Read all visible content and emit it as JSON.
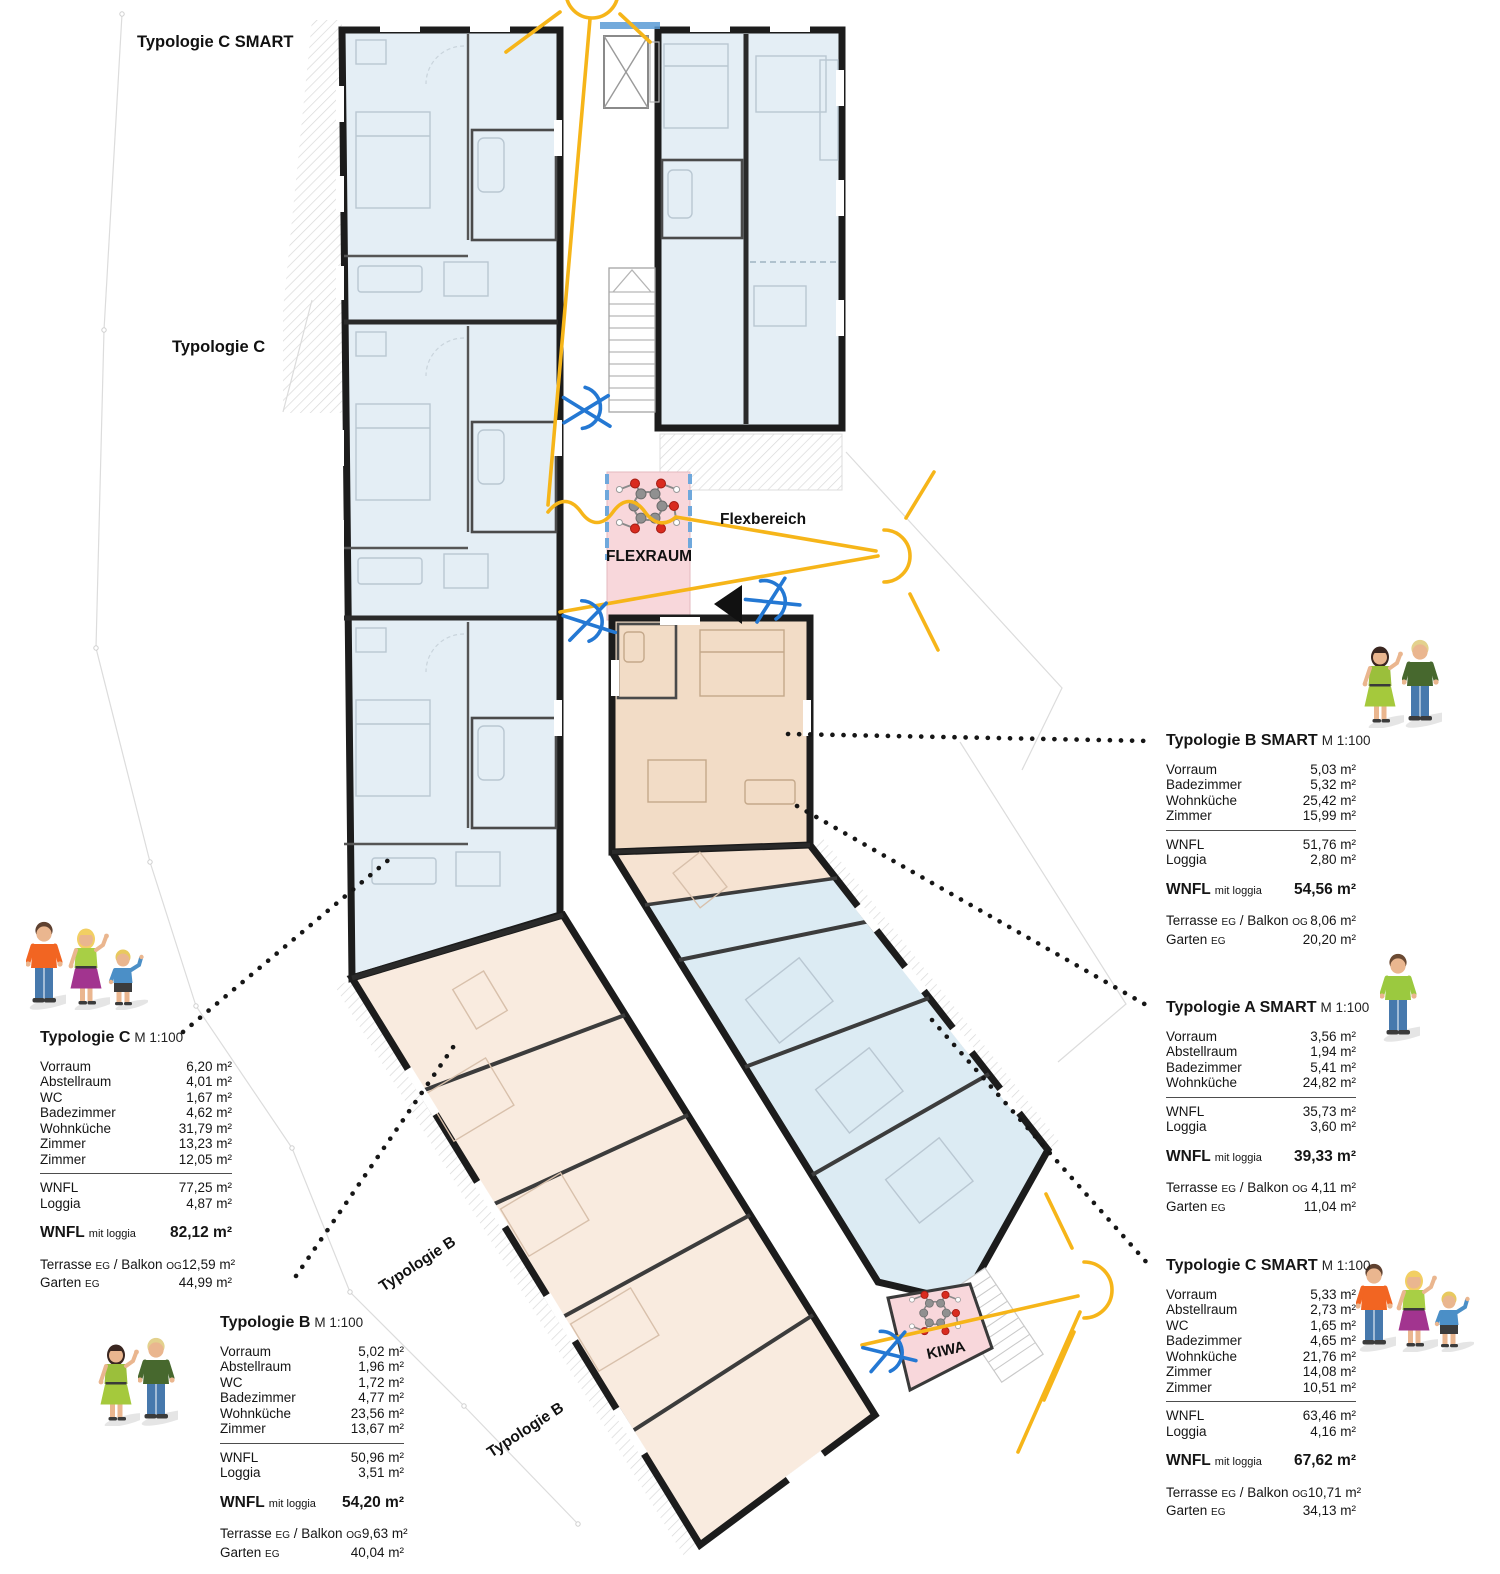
{
  "plan": {
    "labels": {
      "typologie_c_smart": "Typologie C SMART",
      "typologie_c": "Typologie C",
      "typologie_b": "Typologie B",
      "flexraum": "FLEXRAUM",
      "flexbereich": "Flexbereich",
      "kiwa": "KIWA"
    },
    "colors": {
      "room_blue": "#e4eef5",
      "room_orange_light": "#f9ebdf",
      "room_orange": "#f2dcc6",
      "flex_pink": "#f8d7db",
      "wall_black": "#1c1c1c",
      "sun_yellow": "#f6b519",
      "sightline_blue": "#2478d3"
    }
  },
  "tables": [
    {
      "id": "typologie-c",
      "title": "Typologie C",
      "scale": "M 1:100",
      "rooms": [
        {
          "label": "Vorraum",
          "value": "6,20 m²"
        },
        {
          "label": "Abstellraum",
          "value": "4,01 m²"
        },
        {
          "label": "WC",
          "value": "1,67 m²"
        },
        {
          "label": "Badezimmer",
          "value": "4,62 m²"
        },
        {
          "label": "Wohnküche",
          "value": "31,79 m²"
        },
        {
          "label": "Zimmer",
          "value": "13,23 m²"
        },
        {
          "label": "Zimmer",
          "value": "12,05 m²"
        }
      ],
      "subtotals": [
        {
          "label": "WNFL",
          "value": "77,25 m²"
        },
        {
          "label": "Loggia",
          "value": "4,87 m²"
        }
      ],
      "total": {
        "label": "WNFL",
        "sublabel": "mit loggia",
        "value": "82,12 m²"
      },
      "extras": [
        {
          "label": "Terrasse EG / Balkon OG",
          "value": "12,59 m²"
        },
        {
          "label": "Garten EG",
          "value": "44,99 m²"
        }
      ]
    },
    {
      "id": "typologie-b",
      "title": "Typologie B",
      "scale": "M 1:100",
      "rooms": [
        {
          "label": "Vorraum",
          "value": "5,02 m²"
        },
        {
          "label": "Abstellraum",
          "value": "1,96 m²"
        },
        {
          "label": "WC",
          "value": "1,72 m²"
        },
        {
          "label": "Badezimmer",
          "value": "4,77 m²"
        },
        {
          "label": "Wohnküche",
          "value": "23,56 m²"
        },
        {
          "label": "Zimmer",
          "value": "13,67 m²"
        }
      ],
      "subtotals": [
        {
          "label": "WNFL",
          "value": "50,96 m²"
        },
        {
          "label": "Loggia",
          "value": "3,51 m²"
        }
      ],
      "total": {
        "label": "WNFL",
        "sublabel": "mit loggia",
        "value": "54,20 m²"
      },
      "extras": [
        {
          "label": "Terrasse EG / Balkon OG",
          "value": "9,63 m²"
        },
        {
          "label": "Garten EG",
          "value": "40,04 m²"
        }
      ]
    },
    {
      "id": "typologie-b-smart",
      "title": "Typologie B SMART",
      "scale": "M 1:100",
      "rooms": [
        {
          "label": "Vorraum",
          "value": "5,03 m²"
        },
        {
          "label": "Badezimmer",
          "value": "5,32 m²"
        },
        {
          "label": "Wohnküche",
          "value": "25,42 m²"
        },
        {
          "label": "Zimmer",
          "value": "15,99 m²"
        }
      ],
      "subtotals": [
        {
          "label": "WNFL",
          "value": "51,76 m²"
        },
        {
          "label": "Loggia",
          "value": "2,80 m²"
        }
      ],
      "total": {
        "label": "WNFL",
        "sublabel": "mit loggia",
        "value": "54,56 m²"
      },
      "extras": [
        {
          "label": "Terrasse EG / Balkon OG",
          "value": "8,06 m²"
        },
        {
          "label": "Garten EG",
          "value": "20,20 m²"
        }
      ]
    },
    {
      "id": "typologie-a-smart",
      "title": "Typologie A SMART",
      "scale": "M 1:100",
      "rooms": [
        {
          "label": "Vorraum",
          "value": "3,56 m²"
        },
        {
          "label": "Abstellraum",
          "value": "1,94 m²"
        },
        {
          "label": "Badezimmer",
          "value": "5,41 m²"
        },
        {
          "label": "Wohnküche",
          "value": "24,82 m²"
        }
      ],
      "subtotals": [
        {
          "label": "WNFL",
          "value": "35,73 m²"
        },
        {
          "label": "Loggia",
          "value": "3,60 m²"
        }
      ],
      "total": {
        "label": "WNFL",
        "sublabel": "mit loggia",
        "value": "39,33 m²"
      },
      "extras": [
        {
          "label": "Terrasse EG / Balkon OG",
          "value": "4,11 m²"
        },
        {
          "label": "Garten EG",
          "value": "11,04 m²"
        }
      ]
    },
    {
      "id": "typologie-c-smart",
      "title": "Typologie C SMART",
      "scale": "M 1:100",
      "rooms": [
        {
          "label": "Vorraum",
          "value": "5,33 m²"
        },
        {
          "label": "Abstellraum",
          "value": "2,73 m²"
        },
        {
          "label": "WC",
          "value": "1,65 m²"
        },
        {
          "label": "Badezimmer",
          "value": "4,65 m²"
        },
        {
          "label": "Wohnküche",
          "value": "21,76 m²"
        },
        {
          "label": "Zimmer",
          "value": "14,08 m²"
        },
        {
          "label": "Zimmer",
          "value": "10,51 m²"
        }
      ],
      "subtotals": [
        {
          "label": "WNFL",
          "value": "63,46 m²"
        },
        {
          "label": "Loggia",
          "value": "4,16 m²"
        }
      ],
      "total": {
        "label": "WNFL",
        "sublabel": "mit loggia",
        "value": "67,62 m²"
      },
      "extras": [
        {
          "label": "Terrasse EG / Balkon OG",
          "value": "10,71 m²"
        },
        {
          "label": "Garten EG",
          "value": "34,13 m²"
        }
      ]
    }
  ]
}
